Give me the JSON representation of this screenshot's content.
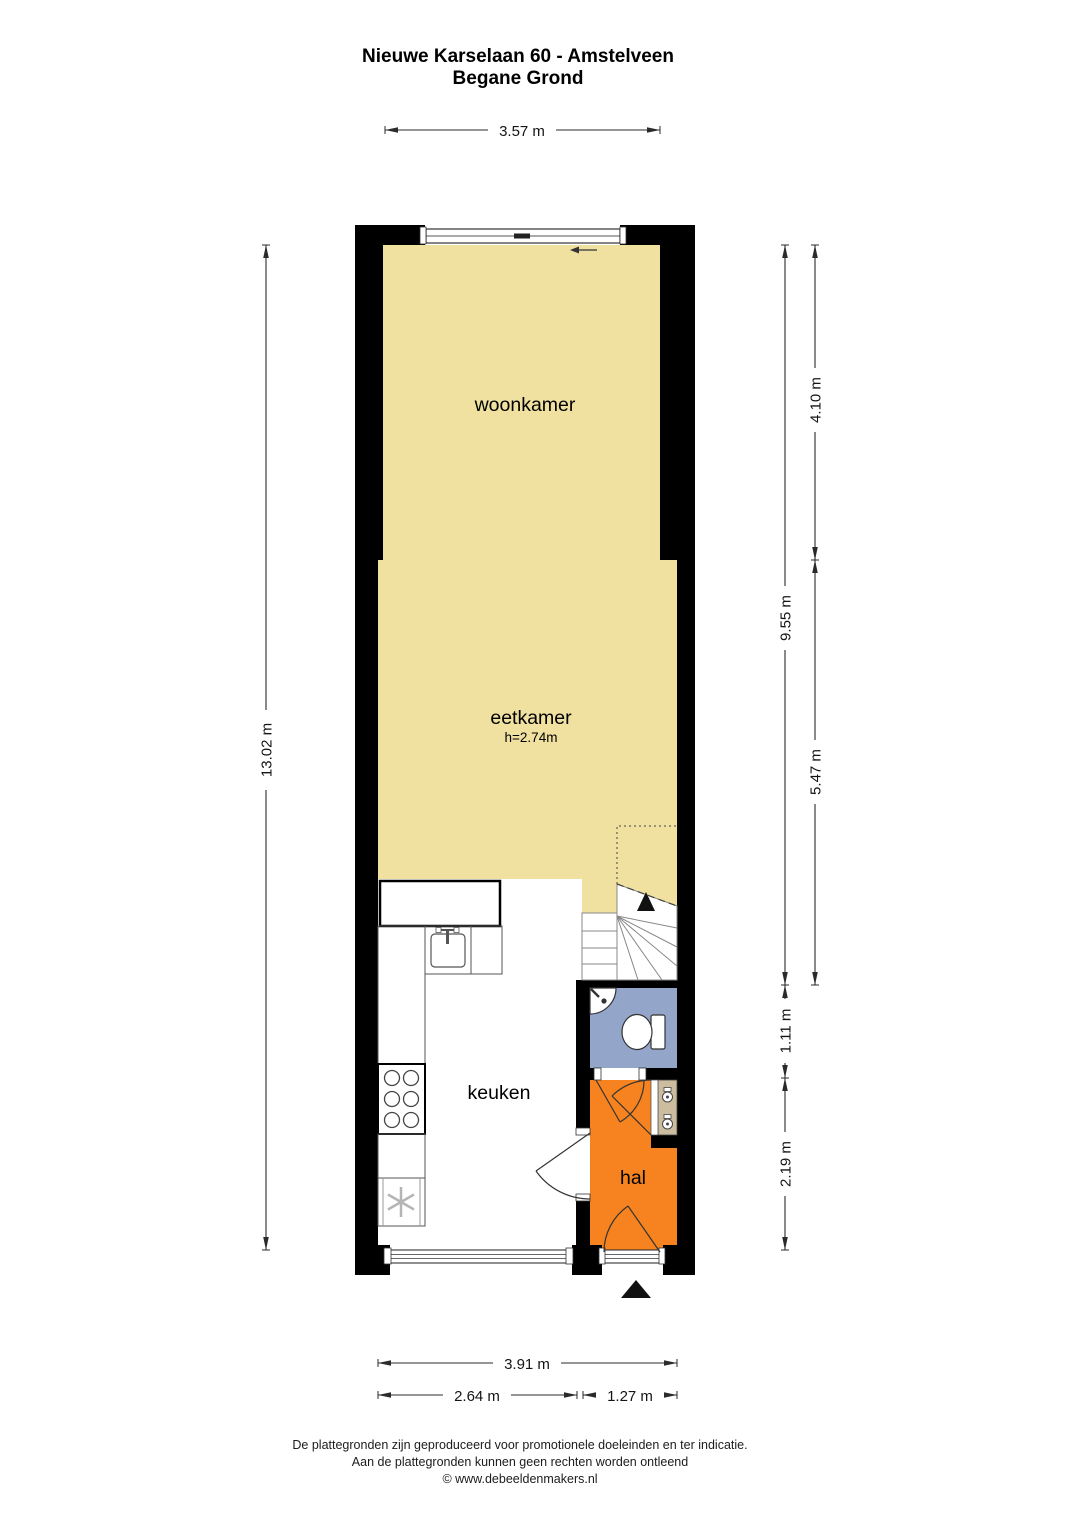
{
  "title": {
    "line1": "Nieuwe Karselaan 60 - Amstelveen",
    "line2": "Begane Grond"
  },
  "rooms": {
    "woonkamer": {
      "label": "woonkamer"
    },
    "eetkamer": {
      "label": "eetkamer",
      "ceiling_height": "h=2.74m"
    },
    "keuken": {
      "label": "keuken"
    },
    "hal": {
      "label": "hal"
    }
  },
  "dimensions": {
    "top_width": "3.57 m",
    "left_total_height": "13.02 m",
    "right_inner_height": "9.55 m",
    "right_upper_height": "4.10 m",
    "right_lower_height": "5.47 m",
    "right_toilet_height": "1.11 m",
    "right_hal_height": "2.19 m",
    "bottom_total_width": "3.91 m",
    "bottom_keuken_width": "2.64 m",
    "bottom_hal_width": "1.27 m"
  },
  "footer": {
    "line1": "De plattegronden zijn geproduceerd voor promotionele doeleinden en ter indicatie.",
    "line2": "Aan de plattegronden kunnen geen rechten worden ontleend",
    "line3": "© www.debeeldenmakers.nl"
  },
  "colors": {
    "living_floor": "#F0E1A0",
    "hall_floor": "#F6831F",
    "toilet_floor": "#93A5C8",
    "meter_cupboard": "#CBBD9E",
    "wall": "#000000"
  }
}
